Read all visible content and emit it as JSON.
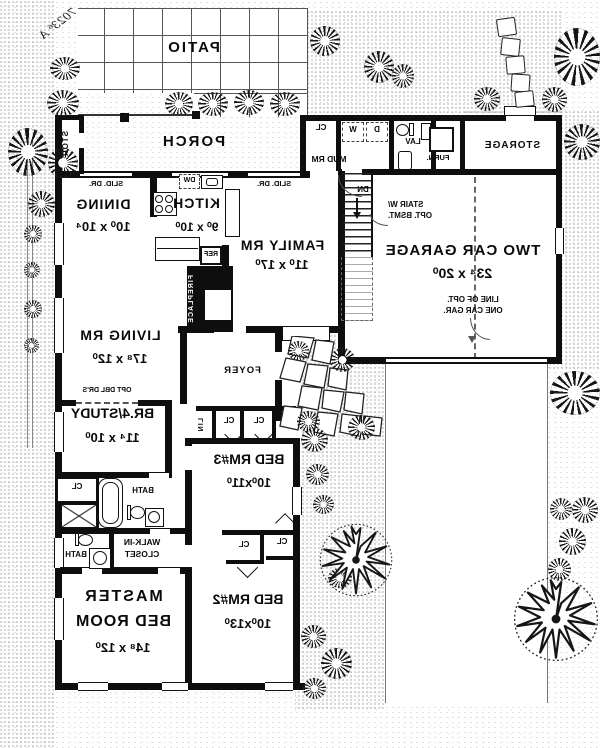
{
  "plan_note": "7023⁶ A",
  "areas": {
    "patio": "PATIO",
    "porch": "PORCH",
    "storage": "STORAGE",
    "stor_closet": "STOR.",
    "mud_room": "MUD RM",
    "lav": "LAV",
    "foyer": "FOYER",
    "bath": "BATH",
    "dining": {
      "name": "DINING",
      "dim": "10⁰ x 10⁴"
    },
    "kitchen": {
      "name": "KITCH",
      "dim": "9⁰ x 10⁰"
    },
    "family": {
      "name": "FAMILY RM",
      "dim": "11⁰ x 17⁰"
    },
    "living": {
      "name": "LIVING RM",
      "dim": "17⁸ x 12⁰"
    },
    "garage": {
      "name": "TWO CAR GARAGE",
      "dim": "23⁴ x 20⁰"
    },
    "br4": {
      "name": "BR.4/STUDY",
      "dim": "11⁴ x 10⁰"
    },
    "bed3": {
      "name": "BED RM#3",
      "dim": "10⁰x11⁰"
    },
    "bed2": {
      "name": "BED RM#2",
      "dim": "10⁰x13⁰"
    },
    "master": {
      "line1": "MASTER",
      "line2": "BED ROOM",
      "dim": "14⁸ x 12⁰"
    },
    "walk_in": {
      "line1": "WALK-IN",
      "line2": "CLOSET"
    }
  },
  "fixtures": {
    "slid_dr": "SLID. DR.",
    "dw": "DW",
    "ref": "REF",
    "fireplace": "FIREPLACE",
    "cl": "CL",
    "lin": "LIN",
    "w": "W",
    "d": "D",
    "furn": "FURN.",
    "dn": "DN",
    "stair_note": {
      "line1": "STAIR W/",
      "line2": "OPT. BSMT."
    },
    "opt_gar": {
      "line1": "LINE OF OPT.",
      "line2": "ONE CAR GAR."
    },
    "opt_dbl_drs": "OPT DBL DR'S"
  }
}
